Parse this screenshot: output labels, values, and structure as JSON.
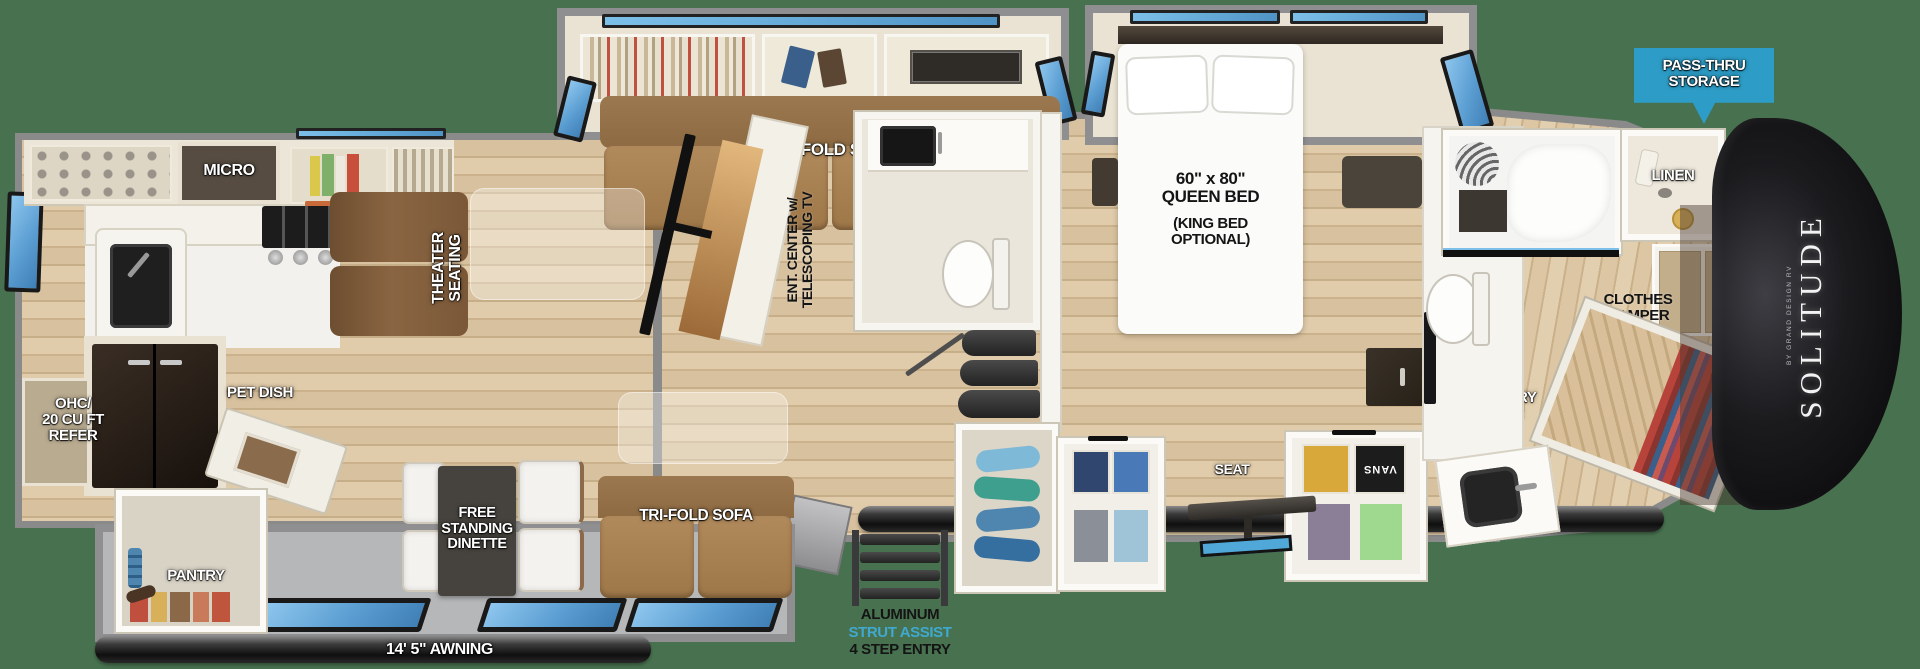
{
  "brand": {
    "name": "SOLITUDE",
    "byline": "BY GRAND DESIGN RV"
  },
  "banner": {
    "text": "PASS-THRU\nSTORAGE"
  },
  "labels": {
    "micro": "MICRO",
    "tri_fold_sofa_top": "TRI-FOLD SOFA",
    "theater_seating": "THEATER\nSEATING",
    "ent_center": "ENT. CENTER w/\nTELESCOPING TV",
    "queen_bed_size": "60\" x 80\"\nQUEEN BED",
    "queen_bed_option": "(KING BED\nOPTIONAL)",
    "linen": "LINEN",
    "clothes_hamper": "CLOTHES\nHAMPER",
    "washer_dryer_prep": "WASHER/\nDRYER\nPREP",
    "accessory_drawer": "ACCESSORY\nDRAWER",
    "seat": "SEAT",
    "ohc_refer": "OHC/\n20 CU FT\nREFER",
    "pet_dish": "PET DISH",
    "free_standing_dinette": "FREE\nSTANDING\nDINETTE",
    "tri_fold_sofa_bottom": "TRI-FOLD SOFA",
    "pantry": "PANTRY",
    "awning_rear": "14' 5\" AWNING",
    "awning_main": "20' AWNING",
    "entry_line1": "ALUMINUM",
    "entry_line2": "STRUT ASSIST",
    "entry_line3": "4 STEP ENTRY"
  },
  "decor": {
    "poster": "VANS"
  },
  "colors": {
    "background_green": "#48724F",
    "banner_blue": "#2D9DC7",
    "strut_assist_blue": "#3FA9D0",
    "window_blue": "#66AEDE",
    "wall_gray": "#8A8A8A",
    "front_cap_black": "#0E0E10",
    "wood_floor": "#D8C19E",
    "sofa_tan": "#A87E50",
    "theater_brown": "#7D5C3A"
  }
}
